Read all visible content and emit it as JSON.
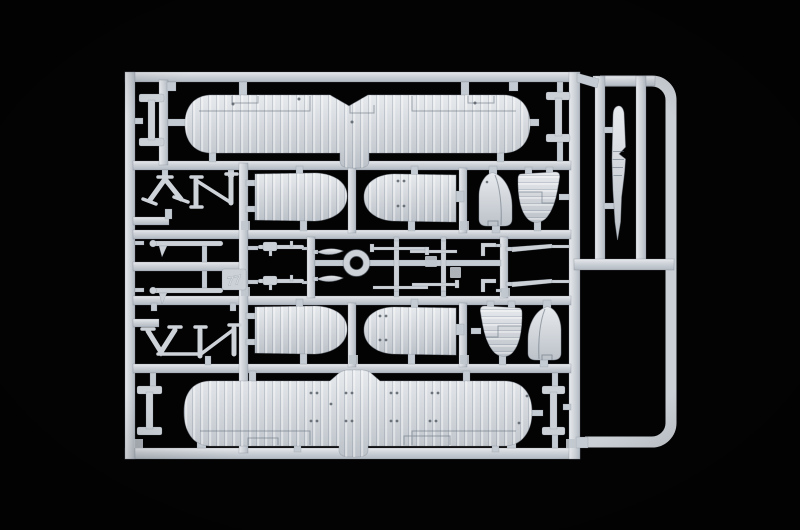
{
  "image": {
    "type": "photograph",
    "subject": "light grey injection-molded plastic model kit sprue with biplane aircraft parts on a black background"
  },
  "colors": {
    "background": "#020202",
    "plastic": "#ccd1d7",
    "plastic_light": "#e7eaed",
    "plastic_dark": "#b2b9c1",
    "outline": "#8e96a0",
    "detail_dot": "#596069"
  },
  "sprue": {
    "embossed_mark": "77",
    "parts_inventory": [
      {
        "name": "upper-wing",
        "count": 1
      },
      {
        "name": "lower-wing-panel",
        "count": 4
      },
      {
        "name": "fin-rudder",
        "count": 2
      },
      {
        "name": "tailplane-half",
        "count": 2
      },
      {
        "name": "interplane-strut",
        "count": 4
      },
      {
        "name": "cabane-strut",
        "count": 4
      },
      {
        "name": "cowling-ring",
        "count": 1
      },
      {
        "name": "machine-gun",
        "count": 2
      },
      {
        "name": "spreader-bar",
        "count": 2
      },
      {
        "name": "small-airfoil",
        "count": 2
      },
      {
        "name": "rigging-rod",
        "count": 8
      },
      {
        "name": "float-blade",
        "count": 1
      }
    ]
  }
}
